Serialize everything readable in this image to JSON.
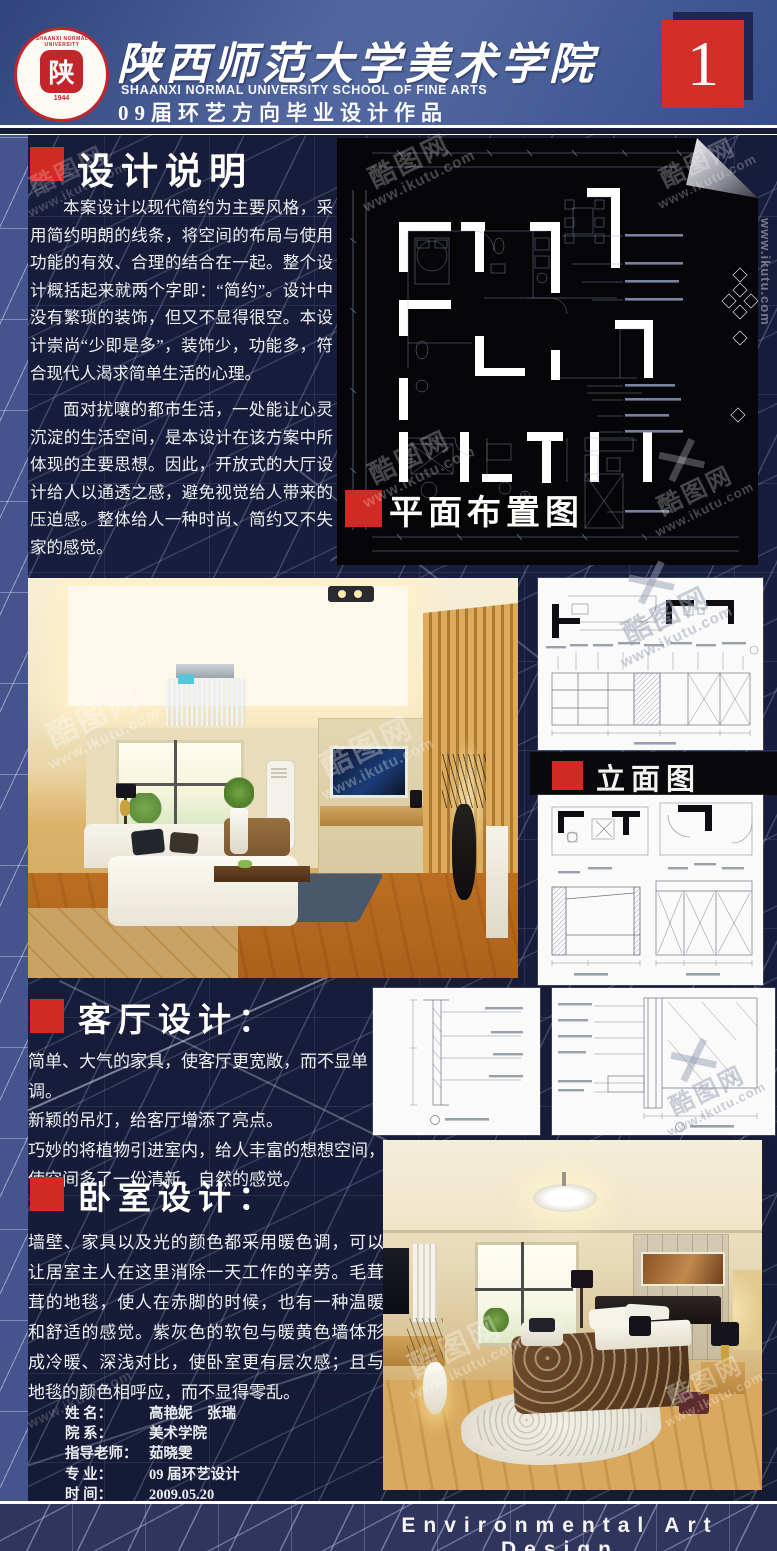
{
  "header": {
    "title_cn": "陕西师范大学美术学院",
    "title_en": "SHAANXI NORMAL UNIVERSITY SCHOOL OF FINE ARTS",
    "subtitle": "09届环艺方向毕业设计作品",
    "page_number": "1",
    "logo": {
      "ring_text": "SHAANXI NORMAL UNIVERSITY",
      "seal_char": "陕",
      "year": "1944"
    }
  },
  "sections": {
    "design_notes": {
      "heading": "设计说明",
      "para1": "本案设计以现代简约为主要风格，采用简约明朗的线条，将空间的布局与使用功能的有效、合理的结合在一起。整个设计概括起来就两个字即：“简约”。设计中没有繁琐的装饰，但又不显得很空。本设计崇尚“少即是多”，装饰少，功能多，符合现代人渴求简单生活的心理。",
      "para2": "面对扰嚷的都市生活，一处能让心灵沉淀的生活空间，是本设计在该方案中所体现的主要思想。因此，开放式的大厅设计给人以通透之感，避免视觉给人带来的压迫感。整体给人一种时尚、简约又不失家的感觉。"
    },
    "floor_plan": {
      "label": "平面布置图"
    },
    "elevation": {
      "label": "立面图"
    },
    "living_room": {
      "heading": "客厅设计：",
      "lines": [
        "简单、大气的家具，使客厅更宽敞，而不显单调。",
        "新颖的吊灯，给客厅增添了亮点。",
        "巧妙的将植物引进室内，给人丰富的想想空间，",
        "使空间多了一份清新、自然的感觉。"
      ]
    },
    "bedroom": {
      "heading": "卧室设计：",
      "text": "墙壁、家具以及光的颜色都采用暖色调，可以让居室主人在这里消除一天工作的辛劳。毛茸茸的地毯，使人在赤脚的时候，也有一种温暖和舒适的感觉。紫灰色的软包与暖黄色墙体形成冷暖、深浅对比，使卧室更有层次感；且与地毯的颜色相呼应，而不显得零乱。"
    }
  },
  "credits": {
    "rows": [
      {
        "label": "姓  名：",
        "value": "高艳妮　张瑞"
      },
      {
        "label": "院  系：",
        "value": "美术学院"
      },
      {
        "label": "指导老师：",
        "value": "茹晓雯"
      },
      {
        "label": "专  业：",
        "value": "09 届环艺设计"
      },
      {
        "label": "时  间：",
        "value": "2009.05.20"
      }
    ]
  },
  "footer": {
    "text": "Environmental Art Design"
  },
  "watermark": {
    "site_name": "酷图网",
    "url": "www.ikutu.com"
  },
  "colors": {
    "accent_red": "#cf2b24",
    "header_blue": "#50659d",
    "bg_navy": "#161b38",
    "panel_white": "#fafafa"
  }
}
